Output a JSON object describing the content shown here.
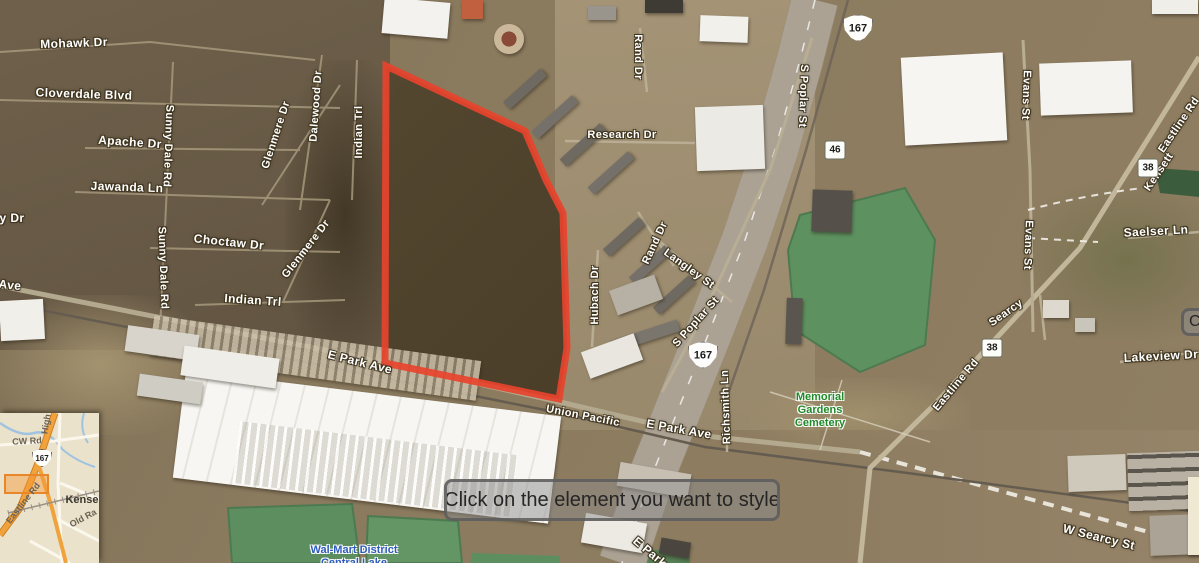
{
  "editor": {
    "tooltip": "Click on the element you want to style",
    "partial_tooltip": "Ca"
  },
  "map": {
    "road_labels": [
      {
        "text": "Mohawk Dr",
        "x": 74,
        "y": 43,
        "rot": -2,
        "size": 12
      },
      {
        "text": "Cloverdale Blvd",
        "x": 84,
        "y": 94,
        "rot": 2,
        "size": 12
      },
      {
        "text": "Apache Dr",
        "x": 130,
        "y": 142,
        "rot": 4,
        "size": 12
      },
      {
        "text": "Jawanda Ln",
        "x": 127,
        "y": 187,
        "rot": 2,
        "size": 12
      },
      {
        "text": "Sunny Dale Rd",
        "x": 168,
        "y": 146,
        "rot": 92,
        "size": 11
      },
      {
        "text": "Sunny Dale Rd",
        "x": 163,
        "y": 268,
        "rot": 88,
        "size": 11
      },
      {
        "text": "y Dr",
        "x": 12,
        "y": 218,
        "rot": 0,
        "size": 12
      },
      {
        "text": "Ave",
        "x": 10,
        "y": 285,
        "rot": 6,
        "size": 12
      },
      {
        "text": "Choctaw Dr",
        "x": 229,
        "y": 242,
        "rot": 6,
        "size": 12
      },
      {
        "text": "Glenmere Dr",
        "x": 276,
        "y": 135,
        "rot": -72,
        "size": 11
      },
      {
        "text": "Glenmere Dr",
        "x": 306,
        "y": 249,
        "rot": -52,
        "size": 11
      },
      {
        "text": "Dalewood Dr",
        "x": 316,
        "y": 106,
        "rot": -86,
        "size": 11
      },
      {
        "text": "Indian Trl",
        "x": 359,
        "y": 132,
        "rot": -90,
        "size": 11
      },
      {
        "text": "Indian Trl",
        "x": 253,
        "y": 300,
        "rot": 4,
        "size": 12
      },
      {
        "text": "E Park Ave",
        "x": 360,
        "y": 362,
        "rot": 14,
        "size": 12
      },
      {
        "text": "Union Pacific",
        "x": 583,
        "y": 416,
        "rot": 11,
        "size": 11
      },
      {
        "text": "E Park Ave",
        "x": 679,
        "y": 429,
        "rot": 10,
        "size": 12
      },
      {
        "text": "E Park",
        "x": 650,
        "y": 552,
        "rot": 40,
        "size": 12
      },
      {
        "text": "Richsmith Ln",
        "x": 726,
        "y": 407,
        "rot": -92,
        "size": 11
      },
      {
        "text": "Research Dr",
        "x": 622,
        "y": 135,
        "rot": 0,
        "size": 11
      },
      {
        "text": "Rand Dr",
        "x": 638,
        "y": 57,
        "rot": 90,
        "size": 11
      },
      {
        "text": "Rand Dr",
        "x": 655,
        "y": 243,
        "rot": -65,
        "size": 11
      },
      {
        "text": "Langley St",
        "x": 689,
        "y": 269,
        "rot": 36,
        "size": 11
      },
      {
        "text": "Hubach Dr",
        "x": 595,
        "y": 295,
        "rot": -90,
        "size": 11
      },
      {
        "text": "S Poplar St",
        "x": 803,
        "y": 96,
        "rot": 92,
        "size": 11
      },
      {
        "text": "S Poplar St",
        "x": 696,
        "y": 322,
        "rot": -48,
        "size": 11
      },
      {
        "text": "Evans St",
        "x": 1026,
        "y": 95,
        "rot": 92,
        "size": 11
      },
      {
        "text": "Evans St",
        "x": 1028,
        "y": 245,
        "rot": 92,
        "size": 11
      },
      {
        "text": "Eastline Rd",
        "x": 1179,
        "y": 125,
        "rot": -56,
        "size": 11
      },
      {
        "text": "Kensett",
        "x": 1159,
        "y": 172,
        "rot": -56,
        "size": 11
      },
      {
        "text": "Saelser Ln",
        "x": 1156,
        "y": 231,
        "rot": -3,
        "size": 12
      },
      {
        "text": "Searcy",
        "x": 1006,
        "y": 313,
        "rot": -35,
        "size": 11
      },
      {
        "text": "Eastline Rd",
        "x": 956,
        "y": 385,
        "rot": -50,
        "size": 11
      },
      {
        "text": "Lakeview Dr",
        "x": 1161,
        "y": 356,
        "rot": -3,
        "size": 12
      },
      {
        "text": "W Searcy St",
        "x": 1099,
        "y": 537,
        "rot": 14,
        "size": 12
      }
    ],
    "shields": [
      {
        "style": "us",
        "text": "167",
        "x": 858,
        "y": 28
      },
      {
        "style": "us",
        "text": "167",
        "x": 703,
        "y": 355
      },
      {
        "style": "box",
        "text": "46",
        "x": 835,
        "y": 150
      },
      {
        "style": "box",
        "text": "38",
        "x": 1148,
        "y": 168
      },
      {
        "style": "box",
        "text": "38",
        "x": 992,
        "y": 348
      }
    ],
    "area_labels": [
      {
        "id": "cemetery",
        "lines": [
          "Memorial",
          "Gardens",
          "Cemetery"
        ],
        "x": 820,
        "y": 391,
        "color": "#1e8a28"
      },
      {
        "id": "lake",
        "lines": [
          "Wal-Mart District",
          "Central Lake"
        ],
        "x": 354,
        "y": 544,
        "color": "#2f5bbf"
      }
    ],
    "parcel_outline": {
      "color": "#e8432d",
      "points": [
        [
          386,
          66
        ],
        [
          525,
          131
        ],
        [
          546,
          180
        ],
        [
          563,
          213
        ],
        [
          567,
          348
        ],
        [
          559,
          399
        ],
        [
          385,
          363
        ]
      ]
    }
  },
  "inset": {
    "labels": [
      {
        "text": "High",
        "x": 46,
        "y": 11,
        "rot": -80,
        "bold": true
      },
      {
        "text": "CW Rd",
        "x": 27,
        "y": 28,
        "rot": -3,
        "bold": true
      },
      {
        "text": "Eastline Rd",
        "x": 23,
        "y": 90,
        "rot": -52,
        "bold": true
      },
      {
        "text": "Kense",
        "x": 82,
        "y": 87,
        "rot": 0,
        "bold": true,
        "city": true
      },
      {
        "text": "Old Ra",
        "x": 83,
        "y": 105,
        "rot": -28,
        "bold": true
      }
    ],
    "shield": {
      "text": "167",
      "x": 42,
      "y": 45
    }
  }
}
